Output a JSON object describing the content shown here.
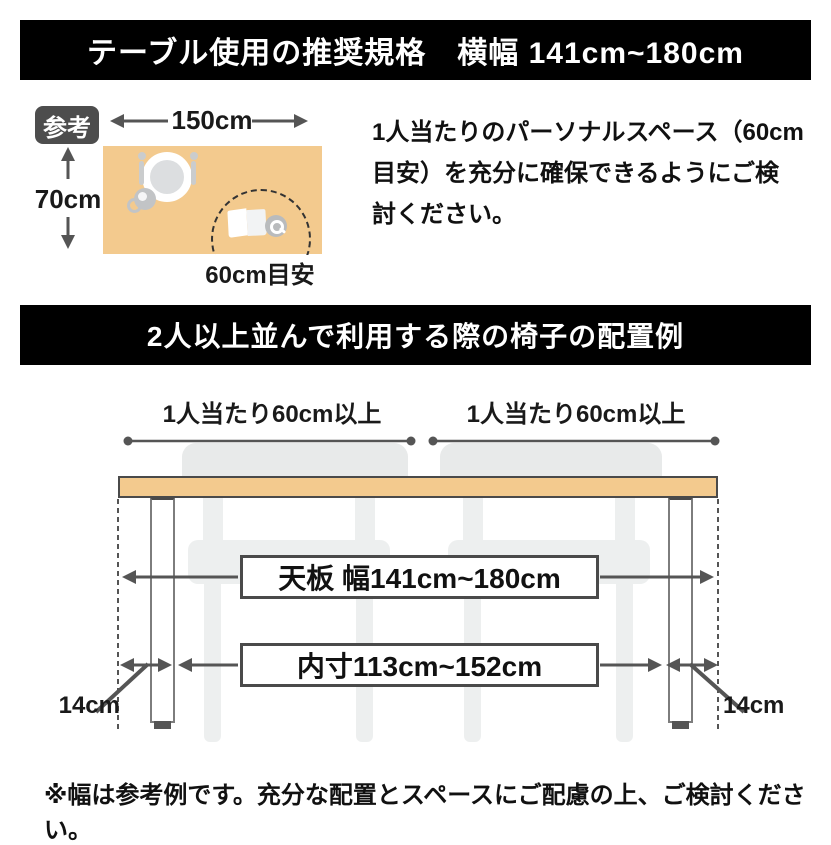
{
  "header_banner": {
    "title": "テーブル使用の推奨規格　横幅 141cm~180cm"
  },
  "reference": {
    "badge": "参考",
    "table_width": "150cm",
    "table_depth": "70cm",
    "personal_space": "60cm目安",
    "description": "1人当たりのパーソナルスペース（60cm\n目安）を充分に確保できるようにご検\n討ください。"
  },
  "section_banner": {
    "title": "2人以上並んで利用する際の椅子の配置例"
  },
  "arrangement": {
    "per_person_left": "1人当たり60cm以上",
    "per_person_right": "1人当たり60cm以上",
    "tabletop_width": "天板 幅141cm~180cm",
    "inner_width": "内寸113cm~152cm",
    "leg_inset_left": "14cm",
    "leg_inset_right": "14cm"
  },
  "footer": {
    "note": "※幅は参考例です。充分な配置とスペースにご配慮の上、ご検討ください。"
  },
  "colors": {
    "banner_bg": "#000000",
    "banner_text": "#ffffff",
    "tabletop_fill": "#f3ca8e",
    "badge_bg": "#4d4d4d",
    "line_gray": "#555555",
    "chair_gray": "#e8eaea",
    "box_border": "#4a4a4a"
  }
}
